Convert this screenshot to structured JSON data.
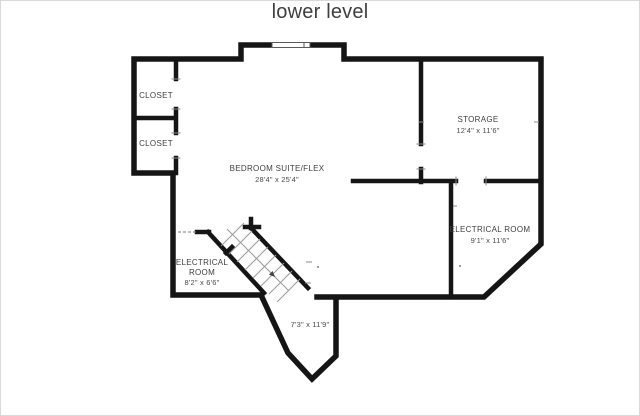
{
  "title": "lower level",
  "colors": {
    "background": "#ffffff",
    "wall": "#151515",
    "label": "#3e3e3e",
    "thin_lines": "#8a8a8a",
    "page_border": "#d9d9d9"
  },
  "rooms": {
    "closet1": {
      "name": "CLOSET"
    },
    "closet2": {
      "name": "CLOSET"
    },
    "bedroom": {
      "name": "BEDROOM SUITE/FLEX",
      "dims": "28'4\" x 25'4\""
    },
    "storage": {
      "name": "STORAGE",
      "dims": "12'4\" x 11'6\""
    },
    "electrical_right": {
      "name": "ELECTRICAL ROOM",
      "dims": "9'1\" x 11'6\""
    },
    "electrical_left": {
      "name_line1": "ELECTRICAL",
      "name_line2": "ROOM",
      "dims": "8'2\" x 6'6\""
    },
    "stairwell": {
      "dims": "7'3\" x 11'9\""
    }
  }
}
